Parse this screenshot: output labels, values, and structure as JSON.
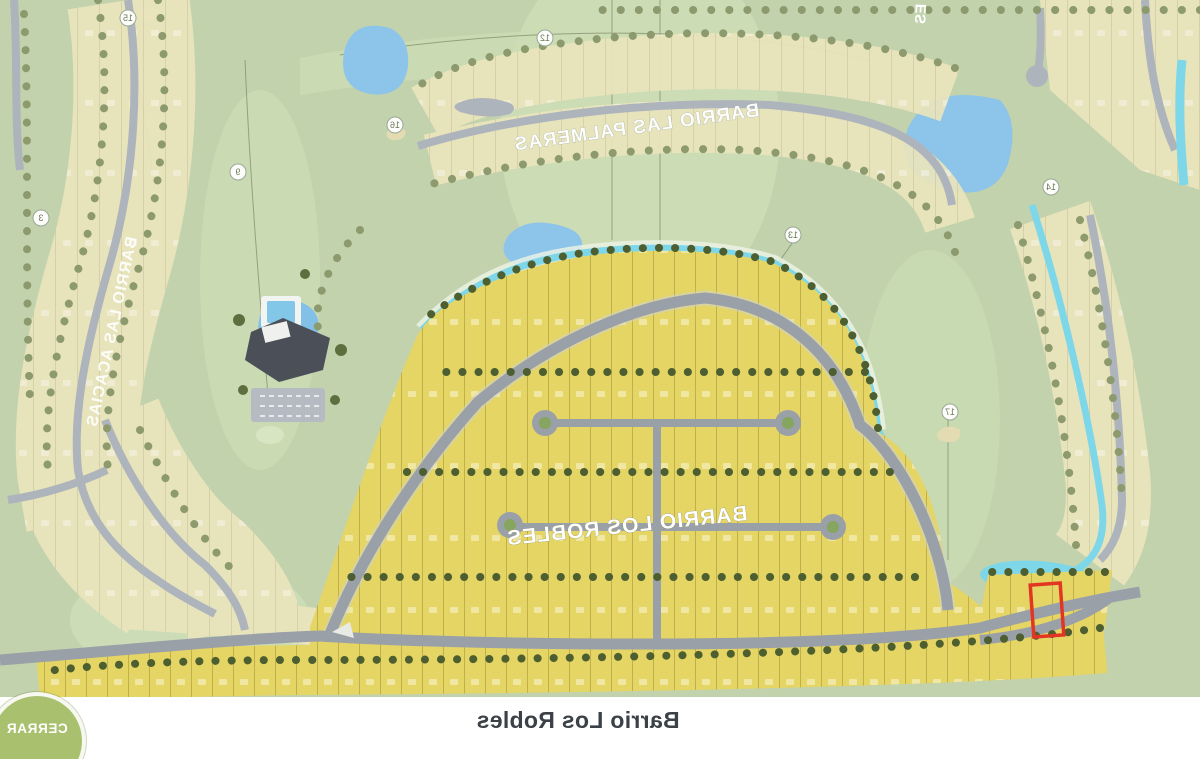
{
  "caption": {
    "text": "Barrio Los Robles"
  },
  "close_button": {
    "label": "CERRAR",
    "color": "#a9c16e"
  },
  "map": {
    "labels": {
      "palmeras": "BARRIO LAS PALMERAS",
      "acacias": "BARRIO LAS ACACIAS",
      "robles": "BARRIO LOS ROBLES",
      "partial_top": "ES"
    },
    "selected_lot": {
      "outline_color": "#e23522"
    },
    "hole_markers": [
      {
        "n": "15",
        "x": 1072,
        "y": 18
      },
      {
        "n": "12",
        "x": 655,
        "y": 38
      },
      {
        "n": "16",
        "x": 805,
        "y": 125
      },
      {
        "n": "14",
        "x": 149,
        "y": 187
      },
      {
        "n": "9",
        "x": 962,
        "y": 172
      },
      {
        "n": "3",
        "x": 1159,
        "y": 218
      },
      {
        "n": "13",
        "x": 407,
        "y": 235
      },
      {
        "n": "17",
        "x": 250,
        "y": 412
      }
    ],
    "colors": {
      "selected_lot_fill": "#e4d564",
      "ghost_lot_fill": "#eae5bd",
      "road": "#9aa0a8",
      "water": "#8cc4ea",
      "boundary_cyan": "#7dd7e9",
      "highlight_red": "#e23522",
      "background_green": "#c2d2ad",
      "tree_green": "#4d5f31",
      "marker_text": "#6a7a58",
      "caption_text": "#3b4147"
    }
  }
}
